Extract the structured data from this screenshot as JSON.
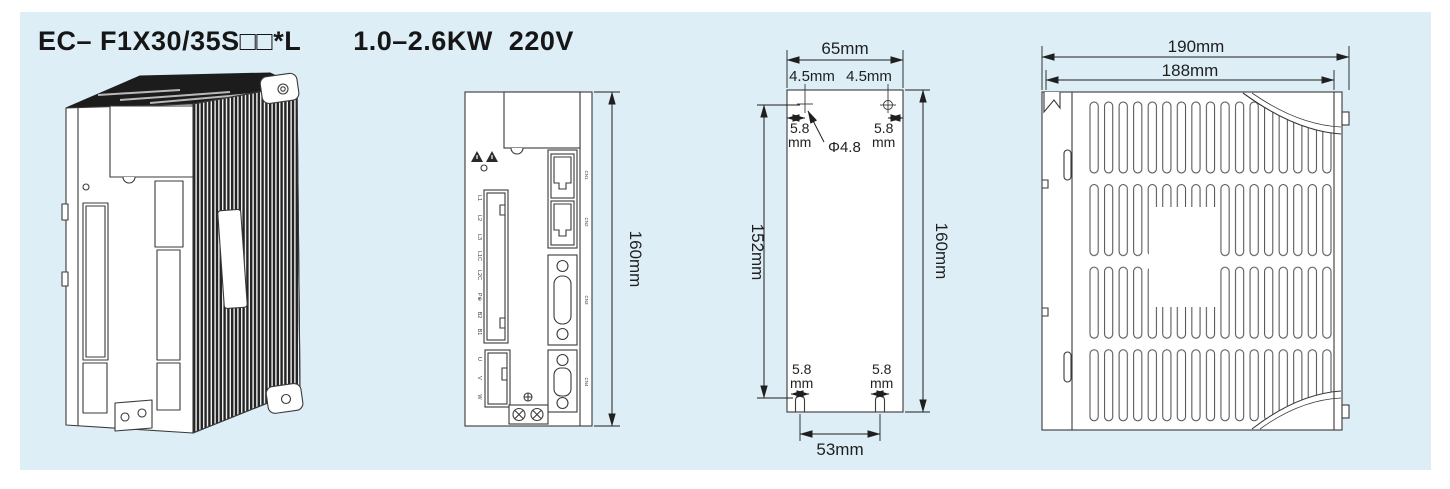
{
  "title": {
    "model": "EC– F1X30/35S□□*L",
    "rating": "1.0–2.6KW  220V"
  },
  "front_view": {
    "height": "160mm",
    "terminals": [
      "L1",
      "L2",
      "L3",
      "L1C",
      "L2C",
      "P⊕",
      "B2",
      "B1"
    ],
    "motor_terminals": [
      "U",
      "V",
      "W"
    ],
    "connector_labels": [
      "CN1",
      "CN2",
      "CN3",
      "CN4"
    ]
  },
  "mounting_view": {
    "overall_width": "65mm",
    "hole_top_offset_left": "4.5mm",
    "hole_top_offset_right": "4.5mm",
    "hole_side_offset_value": "5.8",
    "hole_side_offset_unit": "mm",
    "hole_diameter": "Φ4.8",
    "hole_pitch_height": "152mm",
    "overall_height": "160mm",
    "slot_offset_value": "5.8",
    "slot_offset_unit": "mm",
    "slot_pitch": "53mm"
  },
  "side_view": {
    "overall_depth": "190mm",
    "body_depth": "188mm"
  }
}
